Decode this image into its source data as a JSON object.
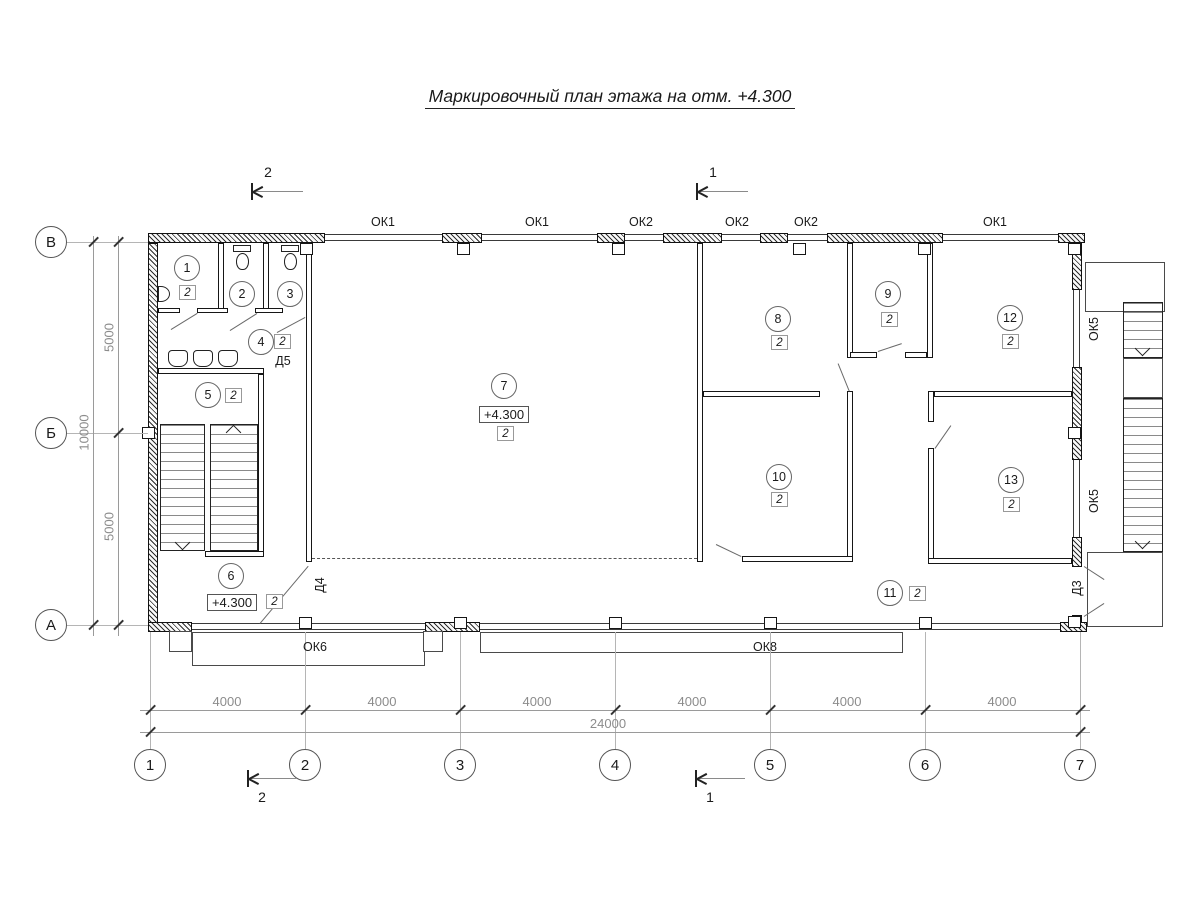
{
  "title": "Маркировочный план этажа на отм. +4.300",
  "axes": {
    "columns": [
      "1",
      "2",
      "3",
      "4",
      "5",
      "6",
      "7"
    ],
    "rows": [
      "В",
      "Б",
      "А"
    ]
  },
  "dimensions": {
    "segments_bottom": [
      "4000",
      "4000",
      "4000",
      "4000",
      "4000",
      "4000"
    ],
    "total_bottom": "24000",
    "segments_left": [
      "5000",
      "5000"
    ],
    "total_left": "10000"
  },
  "sections": {
    "top_2": "2",
    "top_1": "1",
    "bottom_2": "2",
    "bottom_1": "1"
  },
  "windows": {
    "top": [
      "ОК1",
      "ОК1",
      "ОК2",
      "ОК2",
      "ОК2",
      "ОК1"
    ],
    "bottom": [
      "ОК6",
      "ОК8"
    ],
    "right": [
      "ОК5",
      "ОК5"
    ]
  },
  "doors": {
    "d5": "Д5",
    "d4": "Д4",
    "d3": "Д3"
  },
  "elevations": [
    "+4.300",
    "+4.300"
  ],
  "rooms": [
    {
      "n": "1",
      "f": "2"
    },
    {
      "n": "2"
    },
    {
      "n": "3"
    },
    {
      "n": "4",
      "f": "2"
    },
    {
      "n": "5",
      "f": "2"
    },
    {
      "n": "6",
      "f": "2"
    },
    {
      "n": "7",
      "f": "2"
    },
    {
      "n": "8",
      "f": "2"
    },
    {
      "n": "9",
      "f": "2"
    },
    {
      "n": "10",
      "f": "2"
    },
    {
      "n": "11",
      "f": "2"
    },
    {
      "n": "12",
      "f": "2"
    },
    {
      "n": "13",
      "f": "2"
    }
  ]
}
